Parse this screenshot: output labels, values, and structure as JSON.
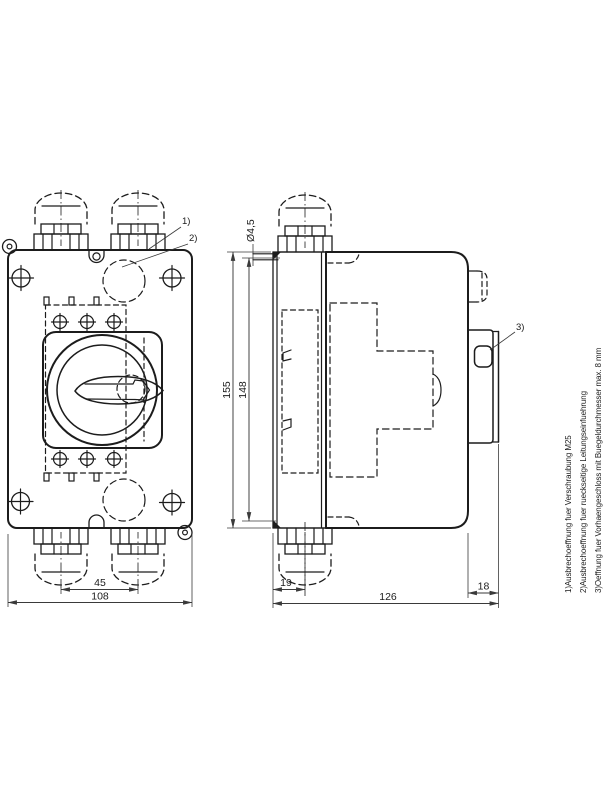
{
  "front": {
    "dim_gland_spacing": "45",
    "dim_width": "108",
    "callout1": "1)",
    "callout2": "2)"
  },
  "side": {
    "hole_dia": "Ø4,5",
    "dim_total_height": "155",
    "dim_inner_height": "148",
    "dim_gland_offset": "19",
    "dim_depth": "126",
    "dim_handle_depth": "18",
    "callout3": "3)"
  },
  "footnotes": [
    "1)Ausbrechoeffnung fuer Verschraubung M25",
    "2)Ausbrechoeffnung fuer rueckseitige Leitungseinfuehrung",
    "3)Oeffnung fuer Vorhaengeschloss mit Buegeldurchmesser max. 8 mm"
  ],
  "colors": {
    "line": "#1c1c1c",
    "background": "#ffffff"
  }
}
